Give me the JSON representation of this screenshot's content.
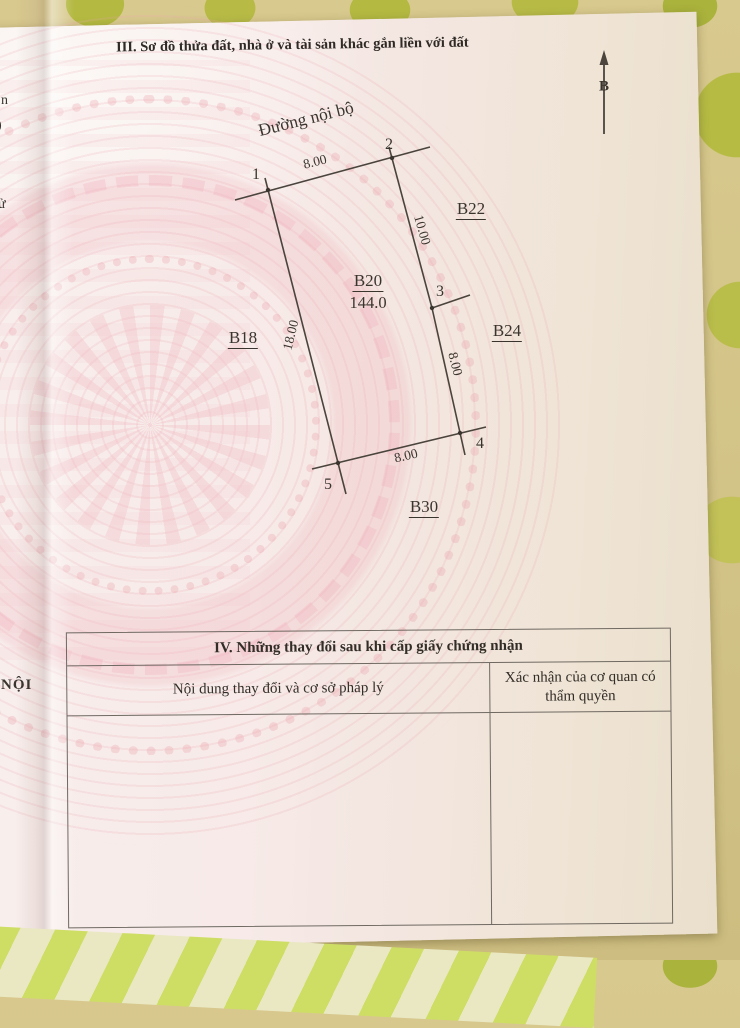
{
  "document": {
    "section3_title": "III. Sơ đồ thửa đất, nhà ở và tài sản khác gắn liền với đất",
    "north_label": "B"
  },
  "diagram": {
    "road_label": "Đường nội bộ",
    "plot_id": "B20",
    "plot_area": "144.0",
    "neighbor_left": "B18",
    "neighbor_top_right": "B22",
    "neighbor_right": "B24",
    "neighbor_bottom": "B30",
    "point_1": "1",
    "point_2": "2",
    "point_3": "3",
    "point_4": "4",
    "point_5": "5",
    "dim_top": "8.00",
    "dim_right_upper": "10.00",
    "dim_right_lower": "8.00",
    "dim_bottom": "8.00",
    "dim_left": "18.00"
  },
  "table": {
    "title": "IV. Những thay đổi sau khi cấp giấy chứng nhận",
    "col_content": "Nội dung thay đổi và cơ sở pháp lý",
    "col_confirm": "Xác nhận của cơ quan có thẩm quyền"
  },
  "edge_fragments": {
    "top": "n",
    "mid": ")",
    "lower": "ử",
    "bottom": "NỘI"
  },
  "colors": {
    "paper_pink": "#f6ebe8",
    "paper_cream": "#eadfcc",
    "guilloche_pink": "#eeb9c0",
    "ink": "#3a342e",
    "table_border": "#6f6962",
    "cloth_olive": "#cfc66f",
    "cloth_green_blob": "#b3b941",
    "stripe_green": "#cede65",
    "stripe_cream": "#e9e8c3"
  }
}
